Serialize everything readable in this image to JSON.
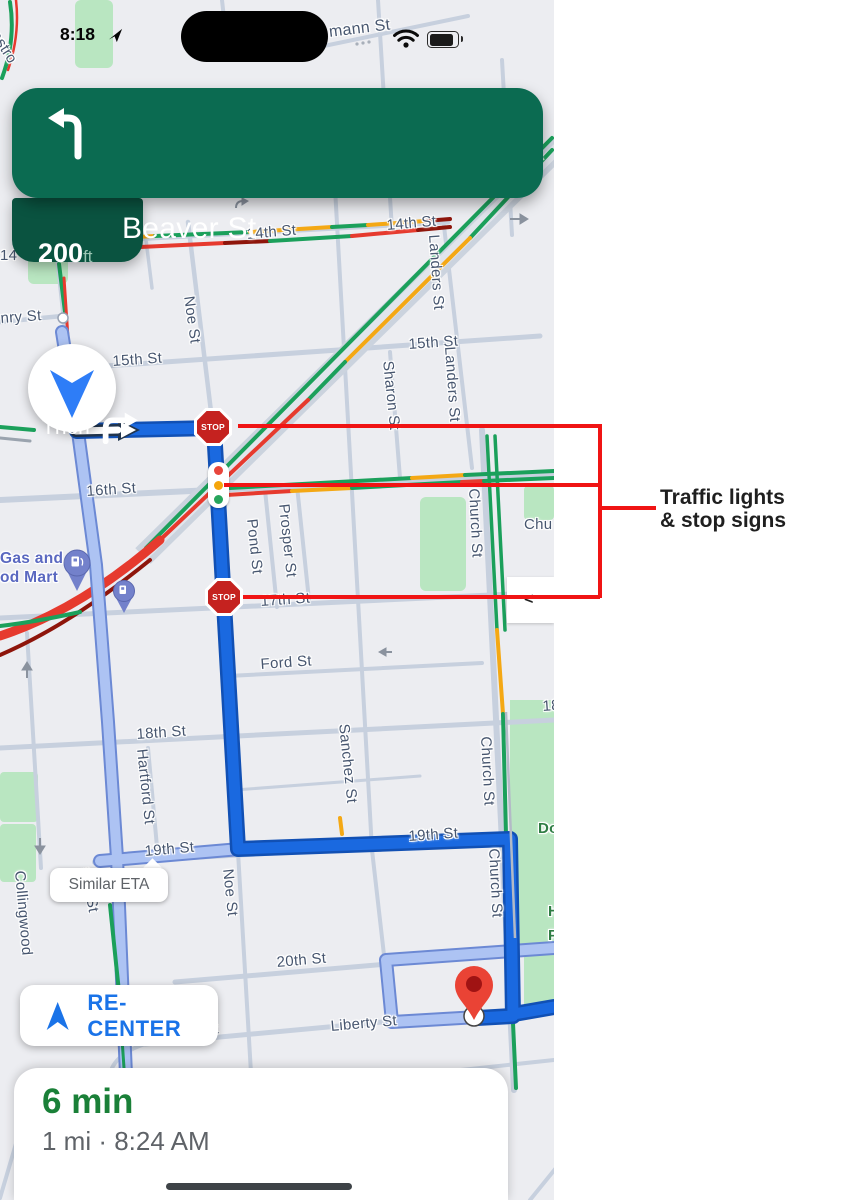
{
  "annotation": {
    "line1": "Traffic lights",
    "line2": "& stop signs",
    "color": "#F01414"
  },
  "status_bar": {
    "time": "8:18"
  },
  "nav_banner": {
    "street": "Beaver St",
    "distance": "200",
    "distance_unit": "ft",
    "then_label": "Then",
    "bg_color": "#0B6B51",
    "then_bg_color": "#0A5340"
  },
  "controls": {
    "similar_eta_label": "Similar ETA",
    "recenter_label": "RE-CENTER",
    "side_panel_chevron": "<",
    "accent_blue": "#1A73E8"
  },
  "bottom_sheet": {
    "eta": "6 min",
    "detail": "1 mi · 8:24 AM",
    "eta_color": "#1A8038"
  },
  "map": {
    "stop_sign_label": "STOP",
    "traffic_colors": {
      "green": "#1BA05B",
      "yellow": "#F4A814",
      "red": "#E63A2E",
      "dark_red": "#8E150B"
    },
    "route_color": "#1A69E0",
    "alt_route_color": "#ADC3F3",
    "park_color": "#B9E6C1",
    "labels": [
      {
        "t": "mann St",
        "x": 328,
        "y": 24,
        "r": -7,
        "fs": 16
      },
      {
        "t": "astro",
        "x": 2,
        "y": 28,
        "r": 58
      },
      {
        "t": "14th St",
        "x": 246,
        "y": 226,
        "r": -5
      },
      {
        "t": "14th St",
        "x": 386,
        "y": 217,
        "r": -5
      },
      {
        "t": "14",
        "x": 0,
        "y": 247
      },
      {
        "t": "nry St",
        "x": 0,
        "y": 310,
        "r": -4
      },
      {
        "t": "15th St",
        "x": 112,
        "y": 353,
        "r": -4
      },
      {
        "t": "15th St",
        "x": 408,
        "y": 336,
        "r": -4
      },
      {
        "t": "Noe St",
        "x": 197,
        "y": 295,
        "r": 82
      },
      {
        "t": "ar",
        "x": 538,
        "y": 146,
        "r": 48
      },
      {
        "t": "Sharon St",
        "x": 396,
        "y": 360,
        "r": 84
      },
      {
        "t": "Landers St",
        "x": 442,
        "y": 234,
        "r": 86
      },
      {
        "t": "Landers St",
        "x": 458,
        "y": 346,
        "r": 86
      },
      {
        "t": "16th St",
        "x": 86,
        "y": 483,
        "r": -4
      },
      {
        "t": "Pond St",
        "x": 260,
        "y": 518,
        "r": 84
      },
      {
        "t": "Prosper St",
        "x": 292,
        "y": 503,
        "r": 84
      },
      {
        "t": "Church St",
        "x": 482,
        "y": 488,
        "r": 87
      },
      {
        "t": "Chu",
        "x": 524,
        "y": 516
      },
      {
        "t": "17th St",
        "x": 260,
        "y": 593,
        "r": -4
      },
      {
        "t": "Ford St",
        "x": 260,
        "y": 656,
        "r": -4
      },
      {
        "t": "18th St",
        "x": 136,
        "y": 726,
        "r": -4
      },
      {
        "t": "18",
        "x": 542,
        "y": 698,
        "r": -4
      },
      {
        "t": "Hartford St",
        "x": 150,
        "y": 748,
        "r": 84
      },
      {
        "t": "Sanchez St",
        "x": 352,
        "y": 723,
        "r": 84
      },
      {
        "t": "Church St",
        "x": 494,
        "y": 736,
        "r": 87
      },
      {
        "t": "Church St",
        "x": 502,
        "y": 848,
        "r": 87
      },
      {
        "t": "19th St",
        "x": 144,
        "y": 843,
        "r": -5
      },
      {
        "t": "19th St",
        "x": 408,
        "y": 828,
        "r": -4
      },
      {
        "t": "Dol",
        "x": 538,
        "y": 820,
        "c": "grn"
      },
      {
        "t": "H",
        "x": 548,
        "y": 903,
        "c": "grn"
      },
      {
        "t": "P",
        "x": 548,
        "y": 927,
        "c": "grn"
      },
      {
        "t": "Noe St",
        "x": 236,
        "y": 868,
        "r": 84
      },
      {
        "t": "Collingwood",
        "x": 28,
        "y": 870,
        "r": 85
      },
      {
        "t": "stro St",
        "x": 94,
        "y": 866,
        "r": 80
      },
      {
        "t": "ro",
        "x": 116,
        "y": 1024,
        "r": 80
      },
      {
        "t": "20th St",
        "x": 276,
        "y": 954,
        "r": -5
      },
      {
        "t": "Liberty St",
        "x": 152,
        "y": 1026,
        "r": -5
      },
      {
        "t": "Liberty St",
        "x": 330,
        "y": 1018,
        "r": -5
      },
      {
        "t": "Gas and",
        "x": 0,
        "y": 550,
        "c": "poi"
      },
      {
        "t": "od Mart",
        "x": 0,
        "y": 569,
        "c": "poi"
      }
    ]
  }
}
